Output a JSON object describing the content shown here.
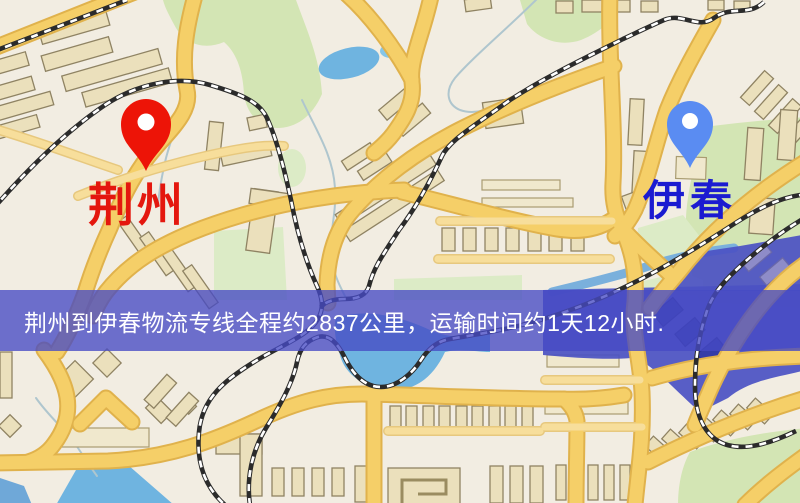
{
  "map": {
    "markers": {
      "origin": {
        "name": "荆州",
        "pin_color": "#ed1407",
        "label_color": "#e4170e"
      },
      "destination": {
        "name": "伊春",
        "pin_color": "#5a8cf2",
        "label_color": "#1b1bd1"
      }
    },
    "palette": {
      "background": "#f2ede2",
      "road": "#f5cf68",
      "road_casing": "#e0b24c",
      "minor_road": "#f7de9b",
      "building": "#ebe0bc",
      "building_outline": "#8f8363",
      "park": "#d3e5b4",
      "water": "#6fb4e0",
      "water_purple": "#4b51c3",
      "railway": "#2b2b2b"
    }
  },
  "banner": {
    "text": "荆州到伊春物流专线全程约2837公里，运输时间约1天12小时.",
    "distance": "约2837公里",
    "duration": "约1天12小时",
    "background": "#464ac4",
    "text_color": "#ffffff"
  }
}
